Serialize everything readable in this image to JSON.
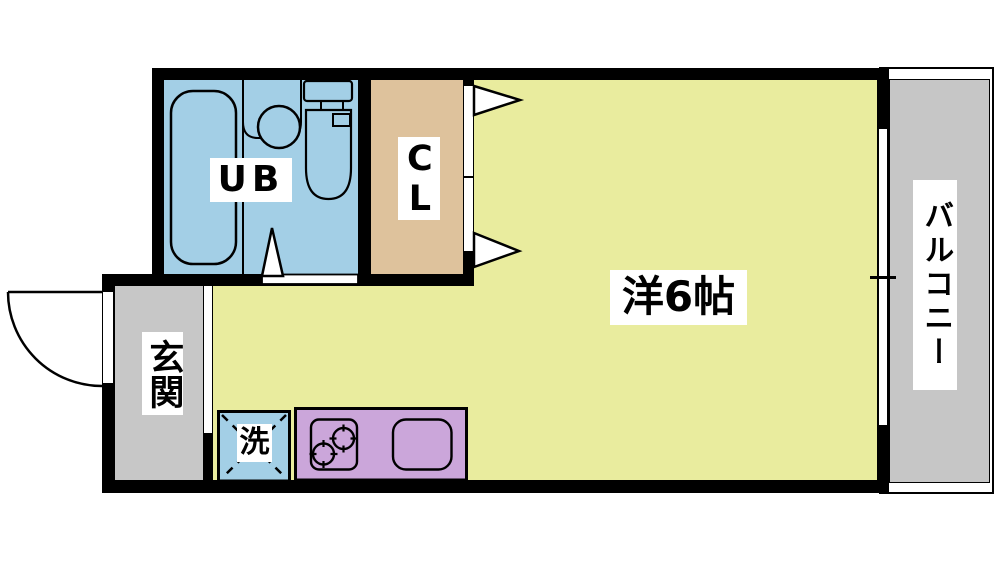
{
  "floorplan": {
    "rooms": {
      "main_room": {
        "label": "洋6帖",
        "color": "#e9ec9e"
      },
      "unit_bath": {
        "label": "UB",
        "color": "#a3cfe6"
      },
      "closet": {
        "label": "CL",
        "color": "#dec29c"
      },
      "entrance": {
        "label": "玄関",
        "color": "#c7c7c7"
      },
      "balcony": {
        "label": "バルコニー",
        "color": "#c6c6c6"
      },
      "laundry_space": {
        "label": "洗",
        "color": "#a3cfe6"
      },
      "kitchen": {
        "color": "#cba6da"
      }
    },
    "wall_color": "#000000",
    "background_color": "#ffffff"
  }
}
